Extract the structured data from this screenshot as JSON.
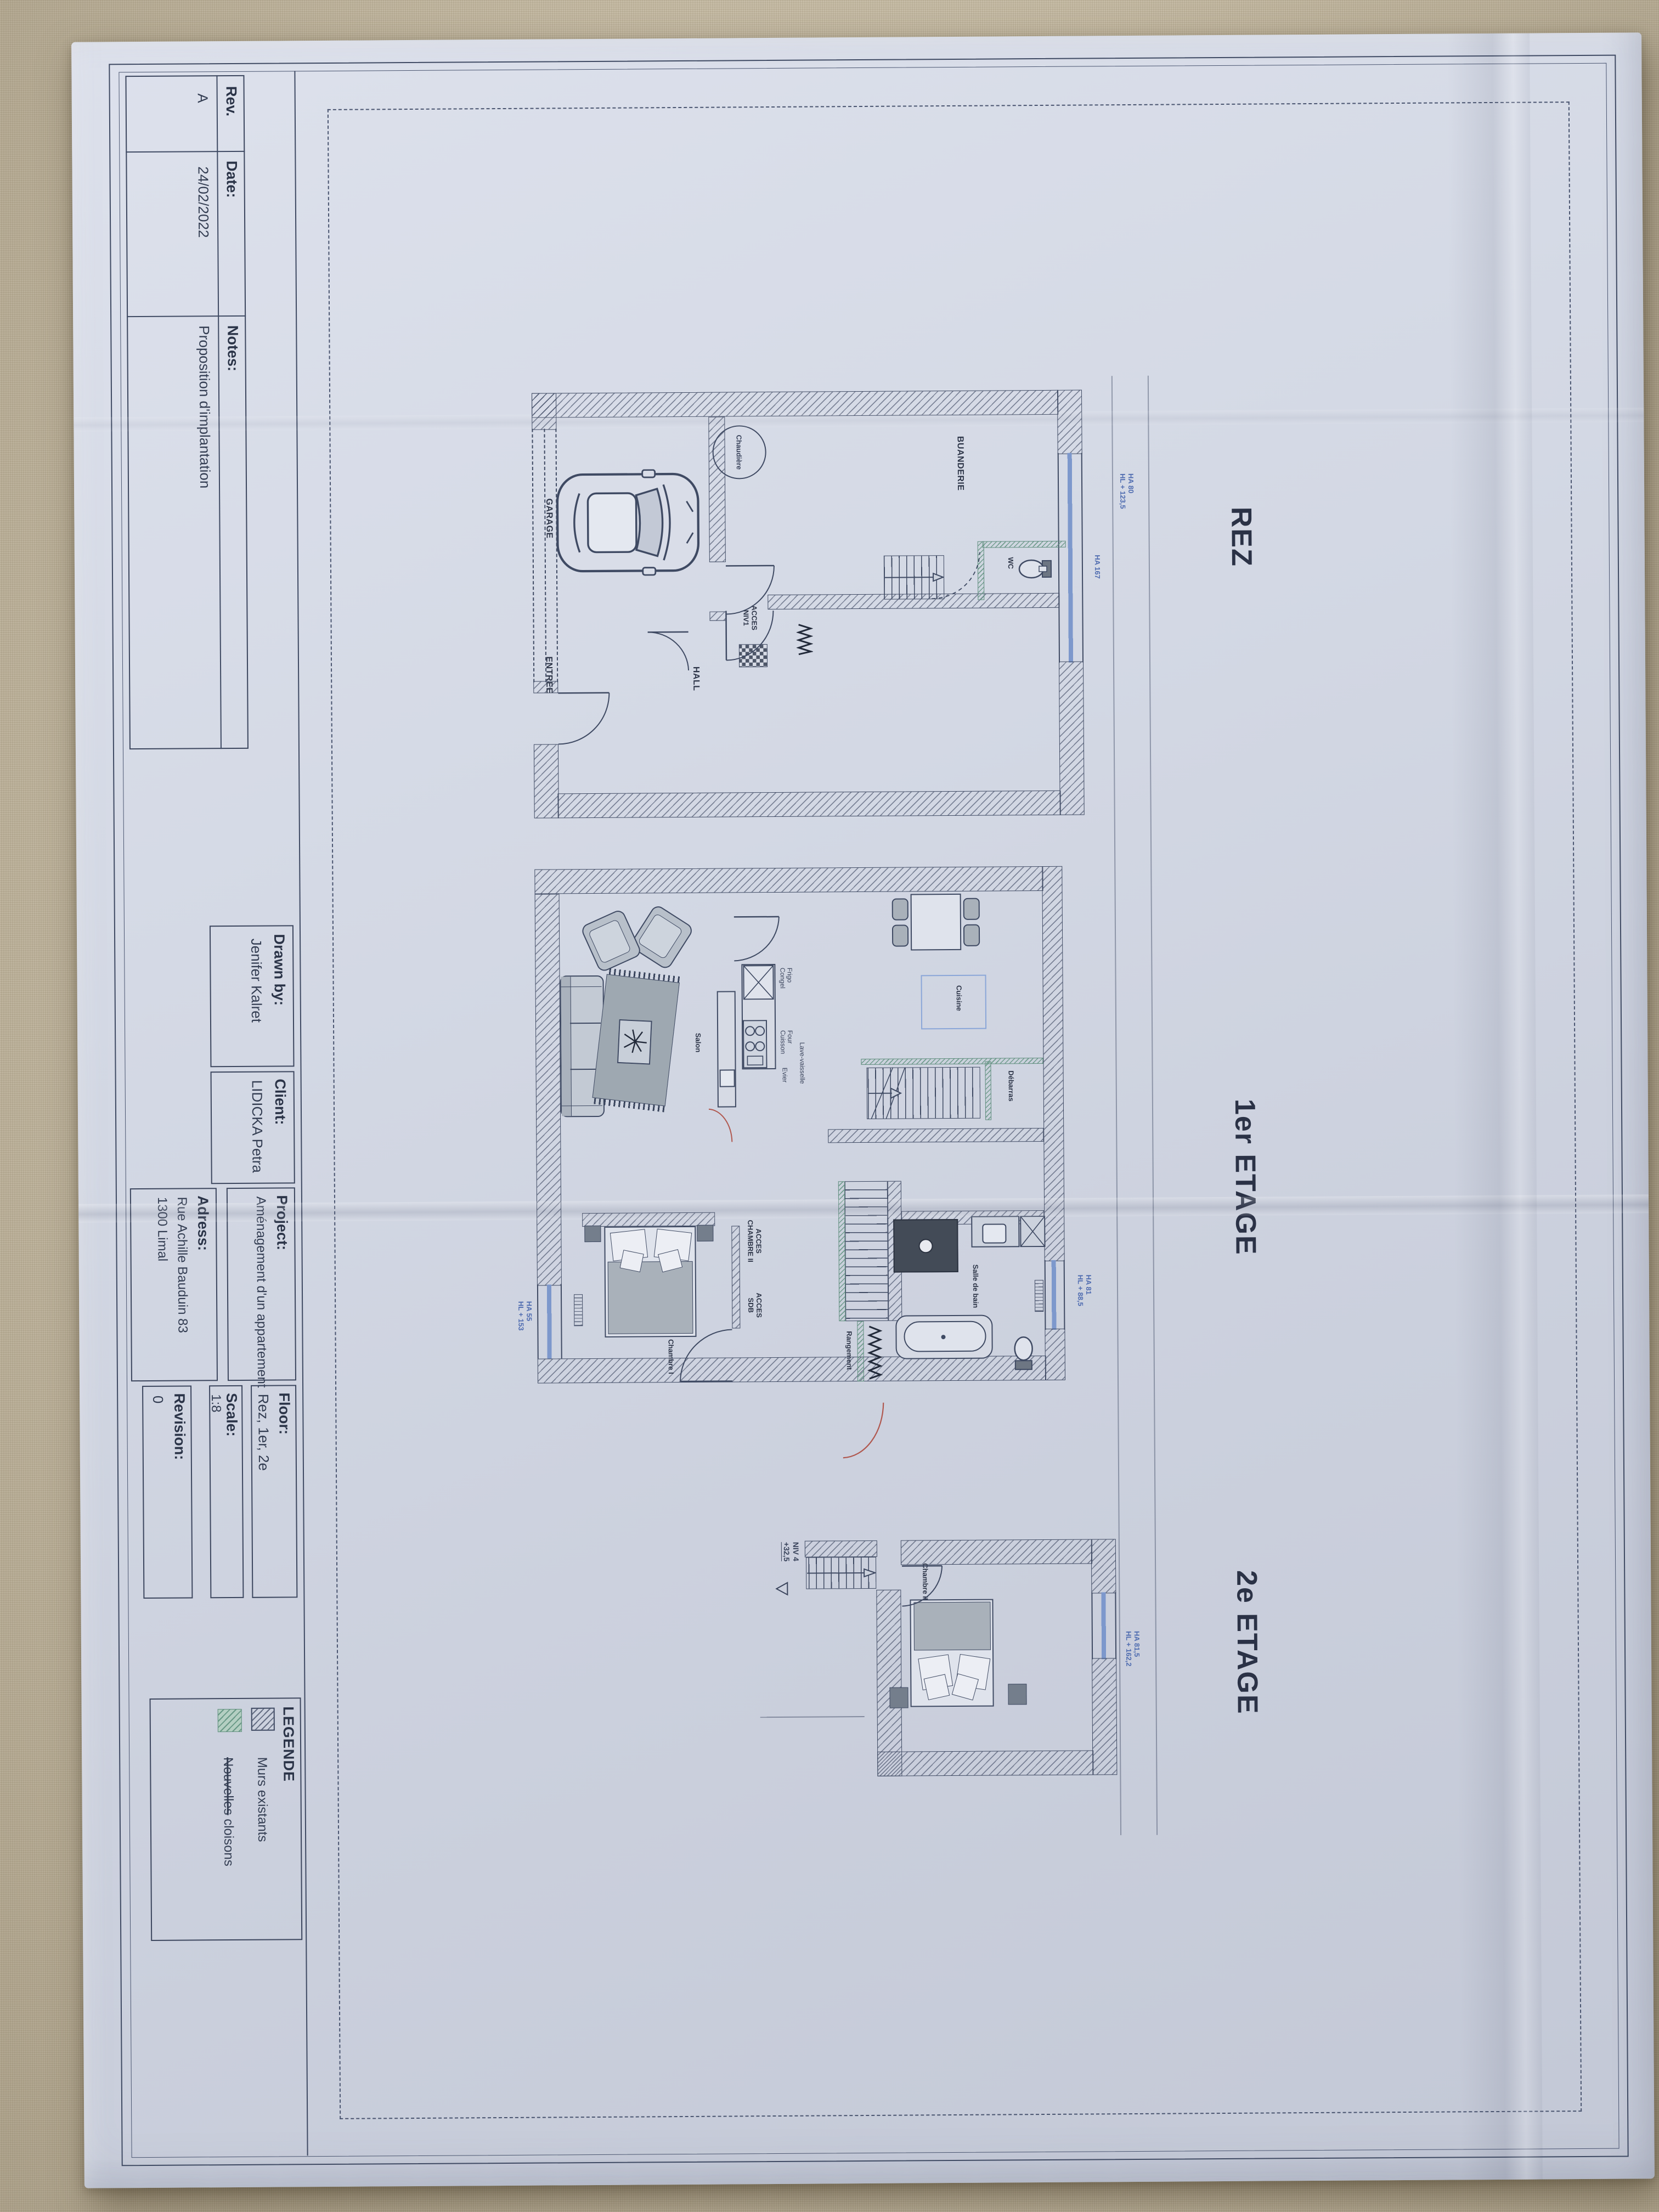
{
  "title_block": {
    "rev_label": "Rev.",
    "rev_value": "A",
    "date_label": "Date:",
    "date_value": "24/02/2022",
    "notes_label": "Notes:",
    "notes_value": "Proposition d'implantation",
    "drawn_label": "Drawn by:",
    "drawn_value": "Jenifer Kalret",
    "client_label": "Client:",
    "client_value": "LIDICKA Petra",
    "project_label": "Project:",
    "project_value": "Aménagement d'un appartement",
    "adress_label": "Adress:",
    "adress_value1": "Rue Achille Bauduin 83",
    "adress_value2": "1300 Limal",
    "floor_label": "Floor:",
    "floor_value": "Rez, 1er, 2e",
    "scale_label": "Scale:",
    "scale_value": "1:8",
    "revision_label": "Revision:",
    "revision_value": "0"
  },
  "legend": {
    "title": "LEGENDE",
    "item1_label": "Murs existants",
    "item2_struck": "Nouvelles",
    "item2_rest": " cloisons"
  },
  "floors": {
    "rez": "REZ",
    "first": "1er ETAGE",
    "second": "2e ETAGE"
  },
  "rez": {
    "garage": "GARAGE",
    "buanderie": "BUANDERIE",
    "wc": "WC",
    "hall": "HALL",
    "entree": "ENTREE",
    "acces1": "ACCES",
    "acces2": "NIV1",
    "chaudiere": "Chaudière",
    "note_top1": "HA 80",
    "note_top2": "HL + 123,5",
    "note_ha167": "HA 167"
  },
  "premier": {
    "cuisine": "Cuisine",
    "salon": "Salon",
    "debarras": "Débarras",
    "rangement": "Rangement",
    "sdb": "Salle de bain",
    "chambre1": "Chambre I",
    "acces_ch_1": "ACCES",
    "acces_ch_2": "CHAMBRE II",
    "acces_sdb_1": "ACCES",
    "acces_sdb_2": "SDB",
    "frigo1": "Frigo",
    "frigo2": "Congel",
    "four1": "Four",
    "four2": "Cuisson",
    "evier": "Evier",
    "lavevaisselle": "Lave-vaisselle",
    "note_sdb1": "HA 81",
    "note_sdb2": "HL + 88,5",
    "note_ch1": "HA 55",
    "note_ch2": "HL + 153"
  },
  "deuxieme": {
    "chambre2": "Chambre II",
    "note1": "HA 81,5",
    "note2": "HL + 162,2",
    "niv": "NIV 4",
    "level": "+32,5"
  }
}
